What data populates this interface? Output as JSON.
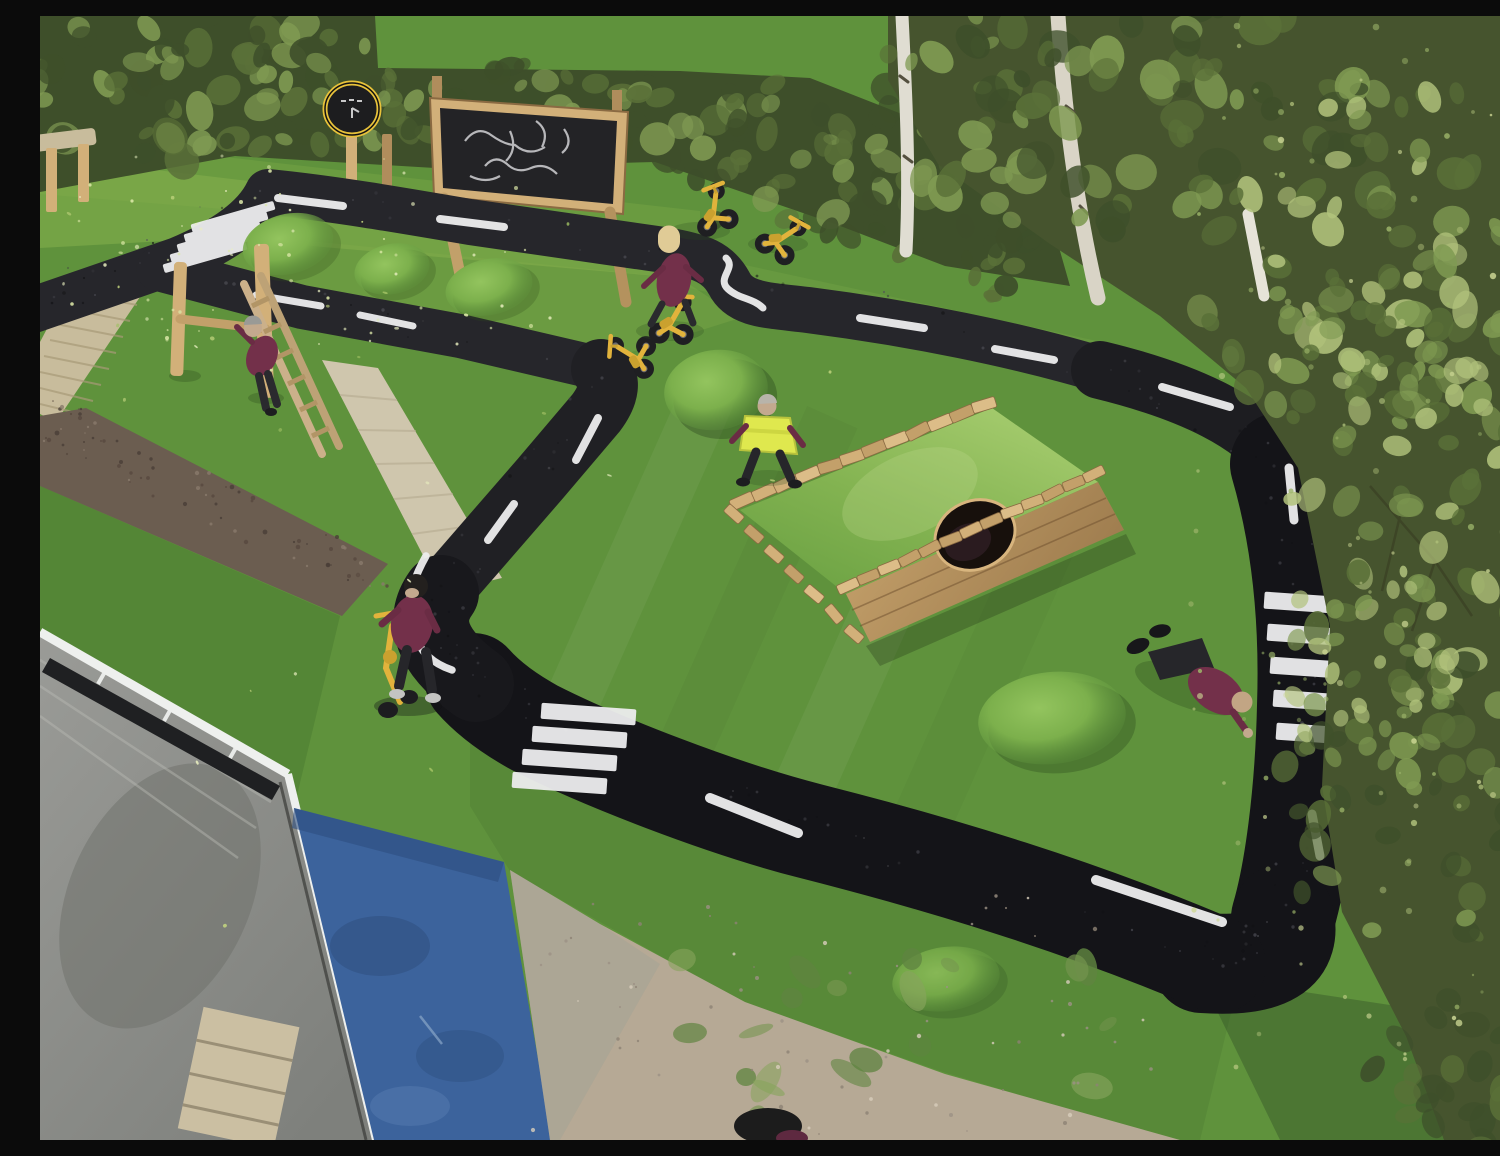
{
  "scene": {
    "title": "Aerial view of a school playground roadway circuit",
    "description": "Drone photograph of a nursery playground: artificial grass field with a black tarmac roadway loop marked with white dashed centre lines and three zebra crossings. Features include three small grass mounds, a larger mound, a timber-edged grass ramp with a round tunnel hole, a wooden climbing frame with ladder, a chalkboard and a round sign on timber posts, a beige paved path, a timber boardwalk and a rubber mulch path. Six children in maroon school jumpers play: one climbs the frame, one rides a yellow trike, one in a hi-vis vest walks by the ramp, one stands with a yellow balance bike, one lies on the grass, and spare yellow trikes are parked by the hedge. A hedge, green mesh fence and birch trees border the top and right; bottom left shows a building roof, a blue safety mat and a bare dirt patch."
  },
  "counts": {
    "children_visible": 6,
    "trikes_and_bikes": 6,
    "zebra_crossings": 3,
    "grass_mounds": 6,
    "signboards": 2
  },
  "objects": {
    "road_loop": {
      "label": "tarmac roadway circuit"
    },
    "zebra_top_left": {
      "label": "zebra crossing top left"
    },
    "zebra_bottom": {
      "label": "zebra crossing bottom"
    },
    "zebra_right": {
      "label": "zebra crossing right"
    },
    "ramp": {
      "label": "timber grass ramp with tunnel"
    },
    "tunnel": {
      "label": "round tunnel opening"
    },
    "climbing_frame": {
      "label": "timber climbing posts with ladder"
    },
    "chalkboard": {
      "label": "outdoor chalkboard on posts"
    },
    "round_sign": {
      "label": "round play clock sign"
    },
    "boardwalk": {
      "label": "timber boardwalk"
    },
    "beige_path": {
      "label": "paved path"
    },
    "mulch_path": {
      "label": "rubber mulch path"
    },
    "blue_mat": {
      "label": "blue safety surface"
    },
    "roof": {
      "label": "building roof"
    },
    "dirt": {
      "label": "bare soil patch"
    },
    "bench": {
      "label": "wooden bench"
    },
    "fence": {
      "label": "green mesh fence"
    },
    "hedge": {
      "label": "boundary hedge"
    },
    "trees": {
      "label": "birch trees"
    }
  },
  "palette": {
    "grass_base": "#5f923c",
    "grass_light": "#74a844",
    "grass_pale": "#85b14c",
    "grass_dark": "#426f2b",
    "mound_light": "#8cbe57",
    "road_dark": "#141418",
    "road_gray": "#26262b",
    "marking_white": "#ededee",
    "hedge_dark": "#3e4f2a",
    "foliage_mid": "#5a7038",
    "foliage_light": "#7f9a52",
    "foliage_pale": "#b2c37c",
    "wood_light": "#d2b079",
    "wood_mid": "#b08d5c",
    "wood_dark": "#8a6a42",
    "board_dark": "#232326",
    "sign_yellow": "#d9b83e",
    "path_beige": "#cfc6ad",
    "mulch_brown": "#6b5d50",
    "deck_tan": "#c8bc9c",
    "mat_blue": "#3c639c",
    "roof_gray": "#8f908c",
    "frame_white": "#eef0ee",
    "dirt_tan": "#b6a995",
    "weed_green": "#74944e",
    "uniform_maroon": "#73304a",
    "hivis_yellow": "#dfe84e",
    "trike_yellow": "#e2b33c",
    "skin_tan": "#c3a98e",
    "fence_pale": "#cdd7ad",
    "field_pale": "#d8e0bc",
    "trunk_white": "#e0ddd2",
    "leaf_litter": "#dce8a8"
  }
}
